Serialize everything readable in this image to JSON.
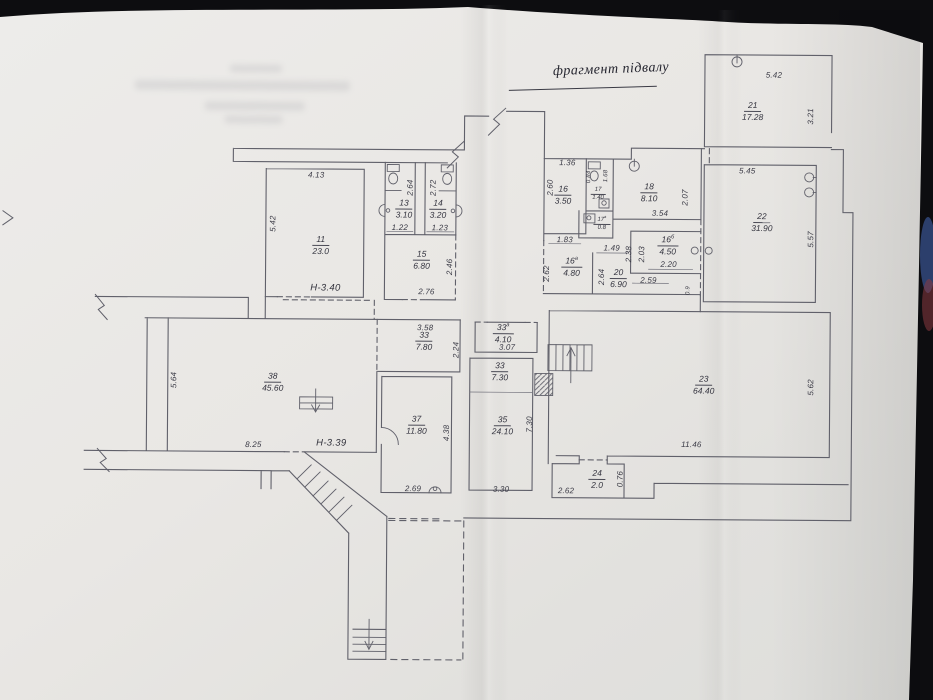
{
  "photo": {
    "backdrop_color": "#0d0d10",
    "paper_color": "#e9e7e4",
    "line_color": "#60606a"
  },
  "title": {
    "text": "фрагмент підвалу"
  },
  "height_labels": {
    "h340": "Н-3.40",
    "h339": "Н-3.39"
  },
  "rooms": {
    "r11": {
      "number": "11",
      "area": "23.0"
    },
    "r13": {
      "number": "13",
      "area": "3.10"
    },
    "r14": {
      "number": "14",
      "area": "3.20"
    },
    "r15": {
      "number": "15",
      "area": "6.80"
    },
    "r16": {
      "number": "16",
      "area": "3.50"
    },
    "r17": {
      "number": "17",
      "area": "1.40"
    },
    "r17a": {
      "number": "17",
      "sup": "а",
      "area": "0.8"
    },
    "r18": {
      "number": "18",
      "area": "8.10"
    },
    "r16a": {
      "number": "16",
      "sup": "а",
      "area": "4.80"
    },
    "r16b": {
      "number": "16",
      "sup": "б",
      "area": "4.50"
    },
    "r20": {
      "number": "20",
      "area": "6.90"
    },
    "r21": {
      "number": "21",
      "area": "17.28"
    },
    "r22": {
      "number": "22",
      "area": "31.90"
    },
    "r23": {
      "number": "23",
      "area": "64.40"
    },
    "r24": {
      "number": "24",
      "area": "2.0"
    },
    "r33": {
      "number": "33",
      "area": "7.80"
    },
    "r33a": {
      "number": "33",
      "sup": "а",
      "area": "4.10"
    },
    "r33b": {
      "number": "33",
      "area": "7.30"
    },
    "r35": {
      "number": "35",
      "area": "24.10"
    },
    "r37": {
      "number": "37",
      "area": "11.80"
    },
    "r38": {
      "number": "38",
      "area": "45.60"
    }
  },
  "dims": {
    "d413": "4.13",
    "d542": "5.42",
    "d122": "1.22",
    "d264": "2.64",
    "d123": "1.23",
    "d272": "2.72",
    "d276": "2.76",
    "d246": "2.46",
    "d136": "1.36",
    "d260": "2.60",
    "d084": "0.84",
    "d168": "1.68",
    "d354": "3.54",
    "d207": "2.07",
    "d183": "1.83",
    "d262": "2.62",
    "d149": "1.49",
    "d238": "2.38",
    "d264b": "2.64",
    "d220": "2.20",
    "d259": "2.59",
    "d203": "2.03",
    "d09": "0.9",
    "d542b": "5.42",
    "d321": "3.21",
    "d545": "5.45",
    "d557": "5.57",
    "d1146": "11.46",
    "d562": "5.62",
    "d262b": "2.62",
    "d076": "0.76",
    "d358": "3.58",
    "d224": "2.24",
    "d307": "3.07",
    "d330": "3.30",
    "d730": "7.30",
    "d269": "2.69",
    "d438": "4.38",
    "d825": "8.25",
    "d564": "5.64"
  }
}
